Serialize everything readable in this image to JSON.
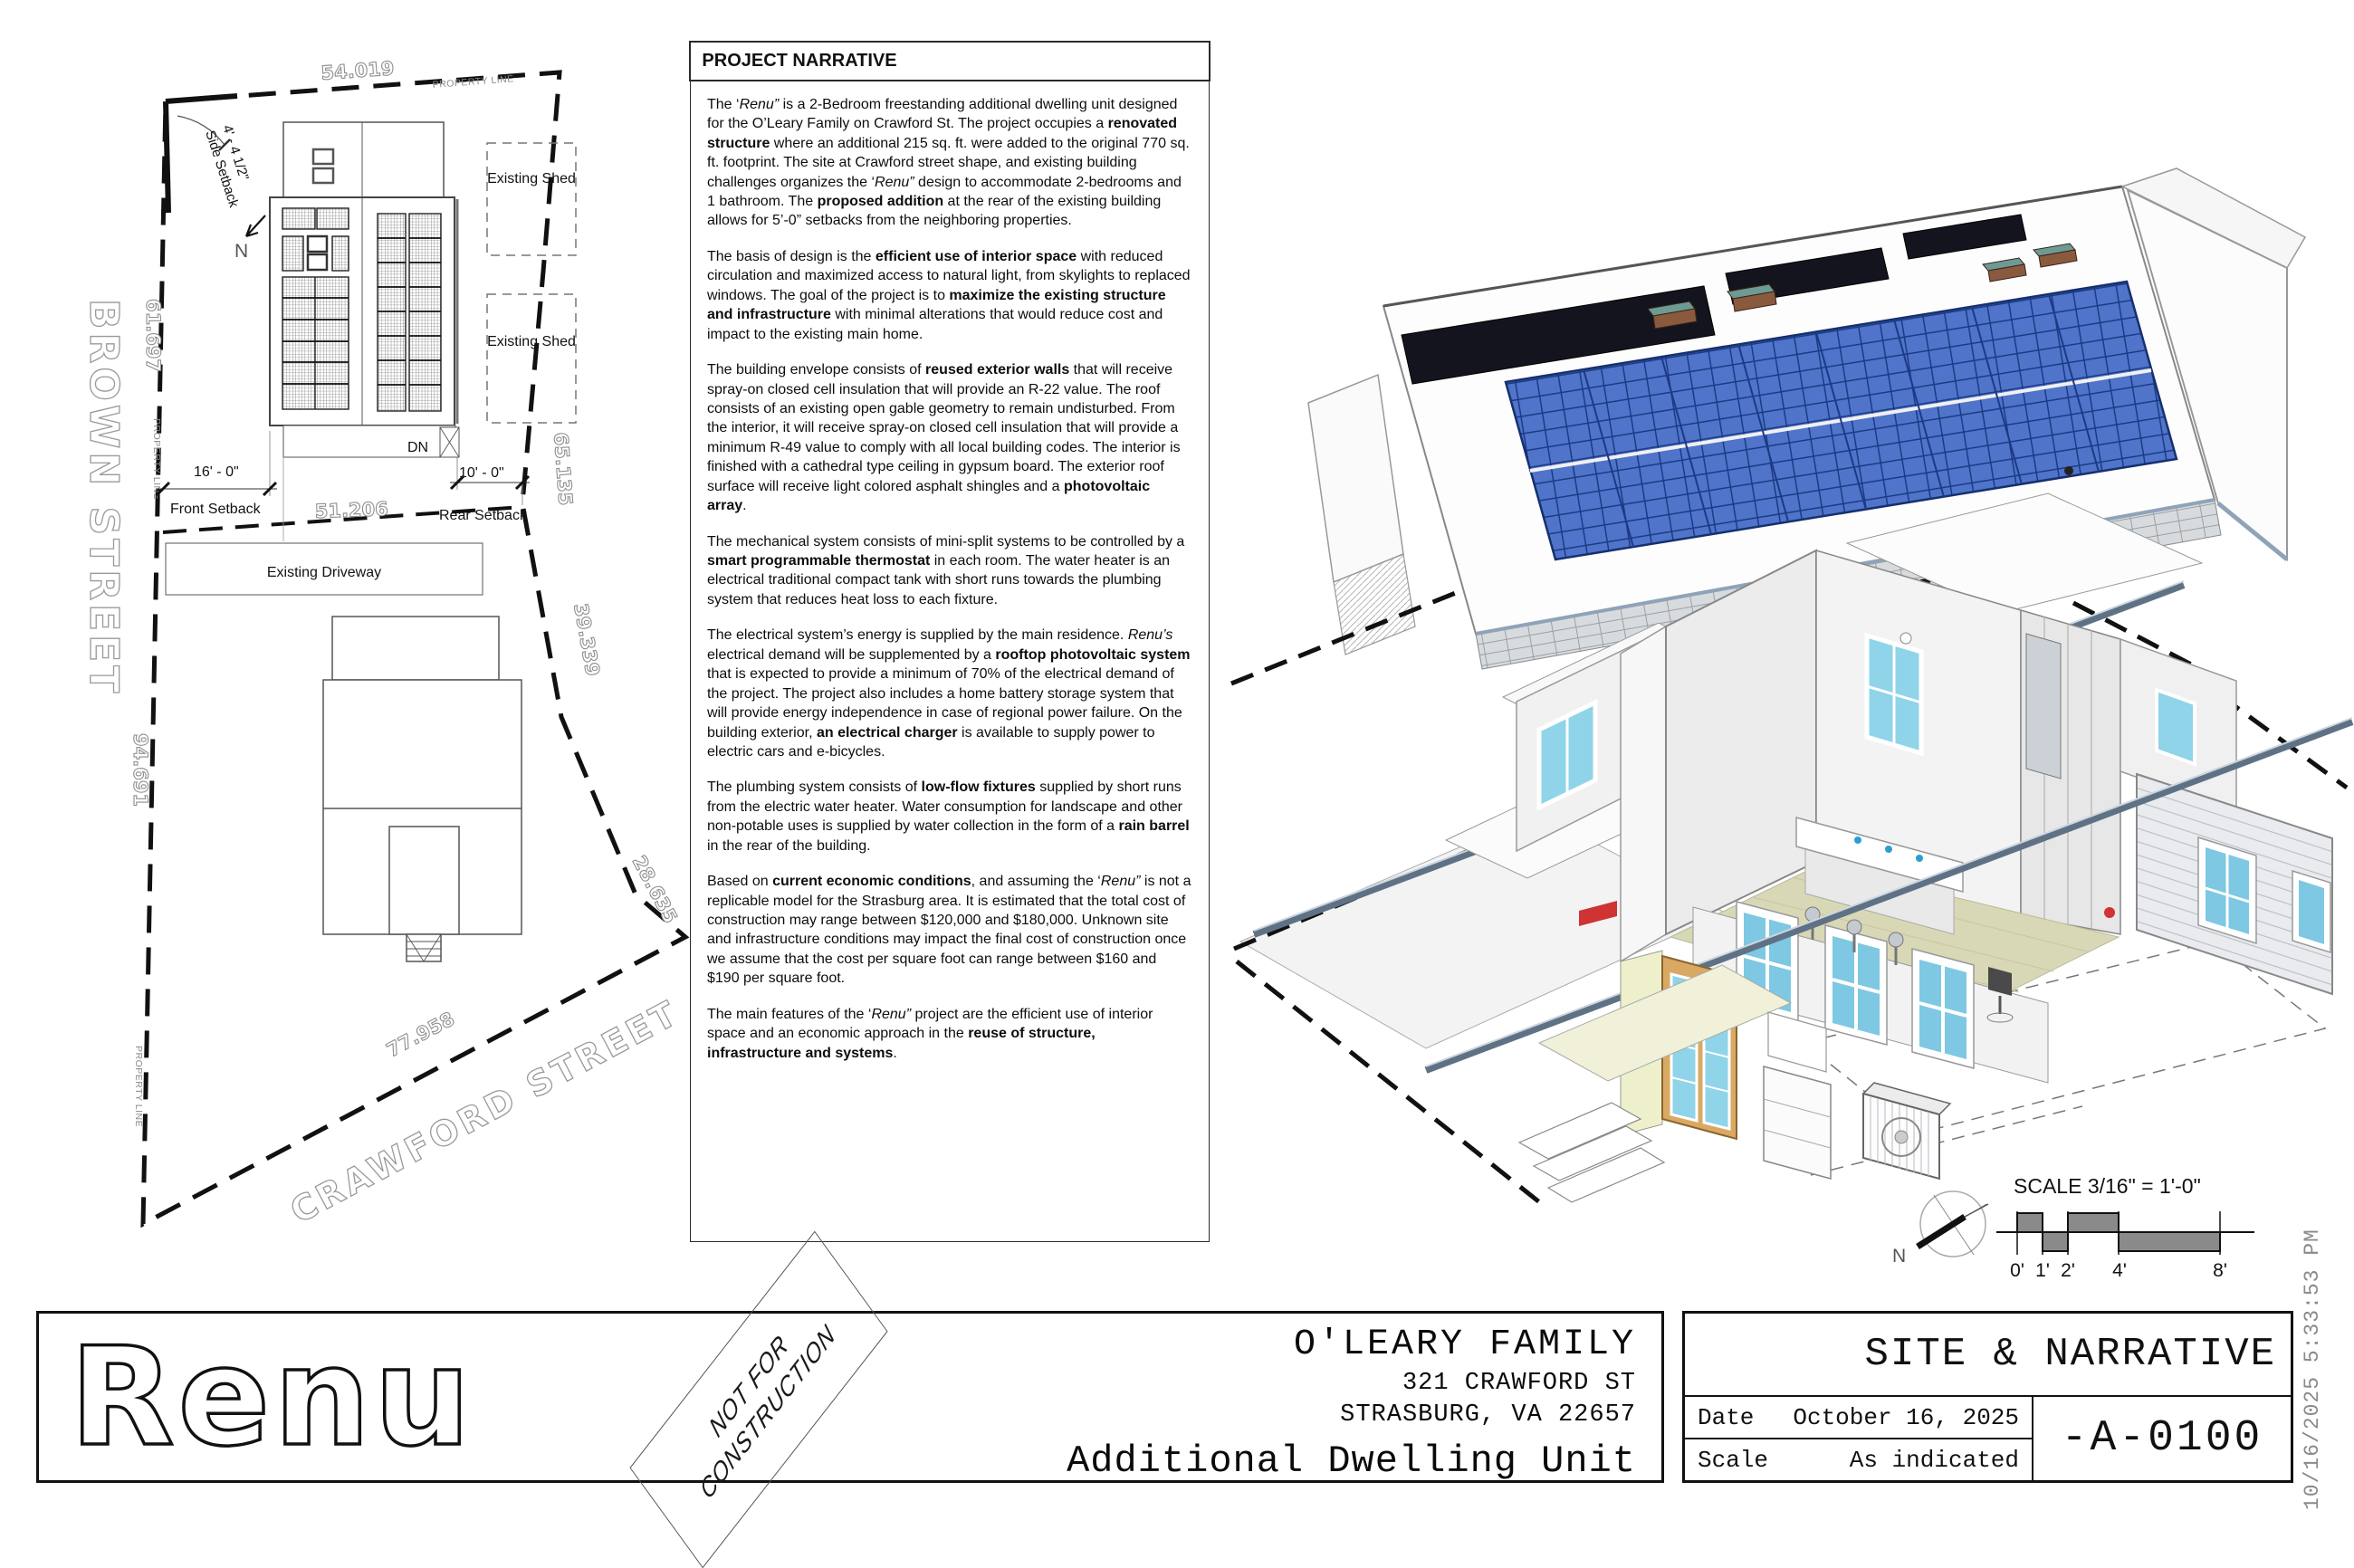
{
  "sheet": {
    "plot_stamp": "10/16/2025 5:33:53 PM"
  },
  "narrative": {
    "title": "PROJECT NARRATIVE",
    "paragraphs": [
      [
        {
          "t": "The ‘"
        },
        {
          "t": "Renu”",
          "s": "i"
        },
        {
          "t": " is a 2-Bedroom freestanding additional dwelling unit designed for the O’Leary Family on Crawford St. The project occupies a "
        },
        {
          "t": "renovated structure",
          "s": "b"
        },
        {
          "t": " where an additional 215 sq. ft. were added to the original 770 sq. ft. footprint. The site at Crawford street shape, and existing building challenges organizes the ‘"
        },
        {
          "t": "Renu”",
          "s": "i"
        },
        {
          "t": " design to accommodate 2-bedrooms and 1 bathroom. The "
        },
        {
          "t": "proposed addition",
          "s": "b"
        },
        {
          "t": " at the rear of the existing building allows for 5’-0” setbacks from the neighboring properties."
        }
      ],
      [
        {
          "t": "The basis of design is the "
        },
        {
          "t": "efficient use of interior space",
          "s": "b"
        },
        {
          "t": " with reduced circulation and maximized access to natural light, from skylights to replaced windows. The goal of the project is to "
        },
        {
          "t": "maximize the existing structure and infrastructure",
          "s": "b"
        },
        {
          "t": " with minimal alterations that would reduce cost and impact to the existing main home."
        }
      ],
      [
        {
          "t": "The building envelope consists of "
        },
        {
          "t": "reused exterior walls",
          "s": "b"
        },
        {
          "t": " that will receive spray-on closed cell insulation that will provide an R-22 value. The roof consists of an existing open gable geometry to remain undisturbed. From the interior, it will receive spray-on closed cell insulation that will provide a minimum R-49 value to comply with all local building codes. The interior is finished with a cathedral type ceiling in gypsum board. The exterior roof surface will receive light colored asphalt shingles and a "
        },
        {
          "t": "photovoltaic array",
          "s": "b"
        },
        {
          "t": "."
        }
      ],
      [
        {
          "t": "The mechanical system consists of mini-split systems to be controlled by a "
        },
        {
          "t": "smart programmable thermostat",
          "s": "b"
        },
        {
          "t": " in each room. The water heater is an electrical traditional compact tank with short runs towards the plumbing system that reduces heat loss to each fixture."
        }
      ],
      [
        {
          "t": "The electrical system’s energy is supplied by the main residence. "
        },
        {
          "t": "Renu’s",
          "s": "i"
        },
        {
          "t": " electrical demand will be supplemented by a "
        },
        {
          "t": "rooftop photovoltaic system",
          "s": "b"
        },
        {
          "t": " that is expected to provide a minimum of 70% of the electrical demand of the project. The project also includes a home battery storage system that will provide energy independence in case of regional power failure. On the building exterior, "
        },
        {
          "t": "an electrical charger",
          "s": "b"
        },
        {
          "t": " is available to supply power to electric cars and e-bicycles."
        }
      ],
      [
        {
          "t": "The plumbing system consists of "
        },
        {
          "t": "low-flow fixtures",
          "s": "b"
        },
        {
          "t": " supplied by short runs from the electric water heater. Water consumption for landscape and other non-potable uses is supplied by water collection in the form of a "
        },
        {
          "t": "rain barrel",
          "s": "b"
        },
        {
          "t": " in the rear of the building."
        }
      ],
      [
        {
          "t": "Based on "
        },
        {
          "t": "current economic conditions",
          "s": "b"
        },
        {
          "t": ", and assuming the ‘"
        },
        {
          "t": "Renu”",
          "s": "i"
        },
        {
          "t": " is not a replicable model for the Strasburg area. It is estimated that the total cost of construction may range between $120,000 and $180,000. Unknown site and infrastructure conditions may impact the final cost of construction once we assume that the cost per square foot can range between $160 and $190 per square foot."
        }
      ],
      [
        {
          "t": "The main features of the ‘"
        },
        {
          "t": "Renu”",
          "s": "i"
        },
        {
          "t": " project are the efficient use of interior space and an economic approach in the "
        },
        {
          "t": "reuse of structure, infrastructure and systems",
          "s": "b"
        },
        {
          "t": "."
        }
      ]
    ]
  },
  "site_plan": {
    "streets": {
      "west": "BROWN STREET",
      "south": "CRAWFORD STREET"
    },
    "property_line_label": "PROPERTY LINE",
    "boundary_dimensions": {
      "north": "54.019",
      "west_upper": "61.697",
      "west_lower": "94.691",
      "east_upper": "65.135",
      "east_mid": "39.339",
      "east_lower": "28.635",
      "south": "77.958",
      "interior": "51.206"
    },
    "setbacks": {
      "side": {
        "dim": "4' - 4 1/2\"",
        "label": "Side Setback"
      },
      "front": {
        "dim": "16' - 0\"",
        "label": "Front Setback"
      },
      "rear": {
        "dim": "10' - 0\"",
        "label": "Rear Setback"
      }
    },
    "labels": {
      "driveway": "Existing Driveway",
      "shed": "Existing Shed",
      "down": "DN",
      "north": "N"
    }
  },
  "scale_indicator": {
    "text": "SCALE 3/16\" = 1'-0\"",
    "ticks": [
      "0'",
      "1'",
      "2'",
      "4'",
      "8'"
    ],
    "north_label": "N"
  },
  "title_block": {
    "logo": "Renu",
    "stamp": {
      "line1": "NOT FOR",
      "line2": "CONSTRUCTION"
    },
    "client": "O'LEARY FAMILY",
    "address_line1": "321 CRAWFORD ST",
    "address_line2": "STRASBURG, VA 22657",
    "project": "Additional Dwelling Unit",
    "sheet_title": "SITE & NARRATIVE",
    "date_label": "Date",
    "date_value": "October 16, 2025",
    "scale_label": "Scale",
    "scale_value": "As indicated",
    "sheet_number": "-A-0100"
  },
  "colors": {
    "pv_panel": "#4f74c9",
    "window_glass": "#7ec8e3",
    "steel_trim": "#5f7285",
    "floor": "#d8d8b6",
    "accent_red": "#cf3333",
    "accent_wall": "#eef0cb"
  }
}
